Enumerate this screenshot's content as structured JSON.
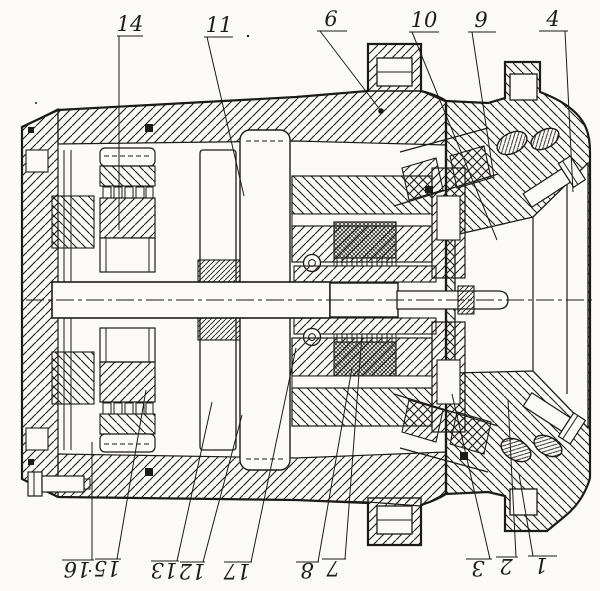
{
  "figure": {
    "ink_color": "#1b1b1b",
    "paper_color": "#fbfaf7"
  },
  "callouts": {
    "top": [
      "14",
      "11",
      "6",
      "10",
      "9",
      "4"
    ],
    "bottom": [
      "16",
      "15",
      "13",
      "12",
      "17",
      "8",
      "7",
      "3",
      "2",
      "1"
    ]
  }
}
